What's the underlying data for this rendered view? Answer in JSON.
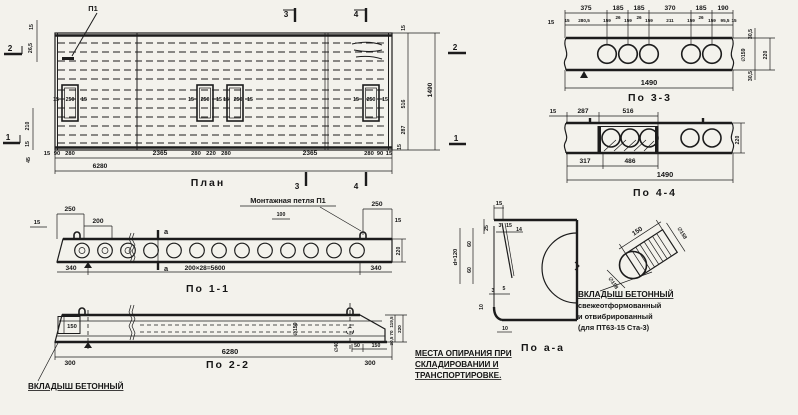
{
  "plan": {
    "title": "План",
    "p1": "П1",
    "m1": "1",
    "m2": "2",
    "m3": "3",
    "m4": "4",
    "open": [
      "15",
      "250",
      "15"
    ],
    "dims_bottom": [
      "15",
      "90",
      "280",
      "2365",
      "280",
      "220",
      "280",
      "2365",
      "280",
      "90",
      "15"
    ],
    "total": "6280",
    "left": [
      "15",
      "26,5",
      "210",
      "15",
      "45"
    ],
    "right": [
      "15",
      "516",
      "287",
      "15"
    ],
    "right_total": "1490"
  },
  "s33": {
    "title": "По 3-3",
    "left15": "15",
    "top": [
      "375",
      "185",
      "185",
      "370",
      "185",
      "190"
    ],
    "mid": [
      "15",
      "280,5",
      "159",
      "26",
      "159",
      "26",
      "159",
      "211",
      "159",
      "26",
      "159",
      "95,5",
      "15"
    ],
    "right": [
      "30,5",
      "∅159",
      "220",
      "30,5"
    ],
    "total": "1490"
  },
  "s44": {
    "title": "По 4-4",
    "top": [
      "15",
      "287",
      "516"
    ],
    "bottom": [
      "317",
      "486"
    ],
    "total": "1490",
    "right220": "220"
  },
  "s11": {
    "title": "По 1-1",
    "loop_label": "Монтажная петля П1",
    "cut": "а",
    "tl": [
      "15",
      "250",
      "200"
    ],
    "dim100": "100",
    "tr": [
      "250",
      "15"
    ],
    "bottom": [
      "340",
      "200×28=5600",
      "340"
    ],
    "right220": "220"
  },
  "s22": {
    "title": "По 2-2",
    "total": "6280",
    "left150": "150",
    "left300": "300",
    "d159": "∅159",
    "d40": "∅40",
    "r50": "50",
    "r150": "150",
    "r300": "300",
    "rv": [
      "119,5",
      "70",
      "30,5"
    ],
    "r220": "220",
    "insert_label": "Вкладыш бетонный"
  },
  "saa": {
    "title": "По а-а",
    "top15": "15",
    "st": [
      "3",
      "15",
      "14"
    ],
    "col": [
      "25",
      "60",
      "60"
    ],
    "d": "d=120",
    "sb": [
      "3",
      "5"
    ],
    "t10a": "10",
    "t10b": "10"
  },
  "ins": {
    "len": "150",
    "dia1": "∅158",
    "dia2": "∅158",
    "lines": [
      "Вкладыш бетонный",
      "свежеотформованный",
      "и отвибрированный",
      "(для ПТ63-15 Ста-3)"
    ]
  },
  "note": {
    "lines": [
      "Места опирания при",
      "складировании и",
      "транспортировке."
    ]
  }
}
